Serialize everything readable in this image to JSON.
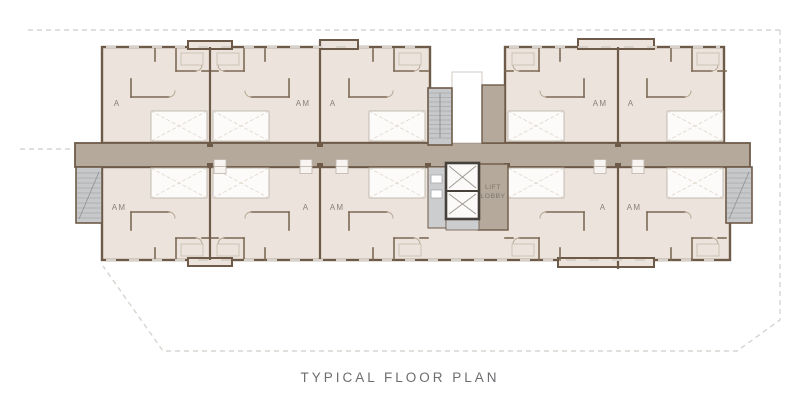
{
  "title": "TYPICAL FLOOR PLAN",
  "plan": {
    "lift_lobby": {
      "line1": "LIFT",
      "line2": "LOBBY"
    },
    "units_top": [
      "A",
      "AM",
      "A",
      "AM",
      "A"
    ],
    "units_bottom": [
      "AM",
      "A",
      "AM",
      "A",
      "AM"
    ],
    "colors": {
      "floor": "#ebe3dc",
      "corridor": "#b5a99c",
      "wall": "#6e5a48",
      "stair_fill": "#c6c8ca",
      "lift_frame": "#45403a",
      "boundary_dash": "#d8d4cf",
      "living_fill": "#fcfbfa",
      "unit_label_text": "#8b8177",
      "title_text": "#6c6d70"
    }
  }
}
